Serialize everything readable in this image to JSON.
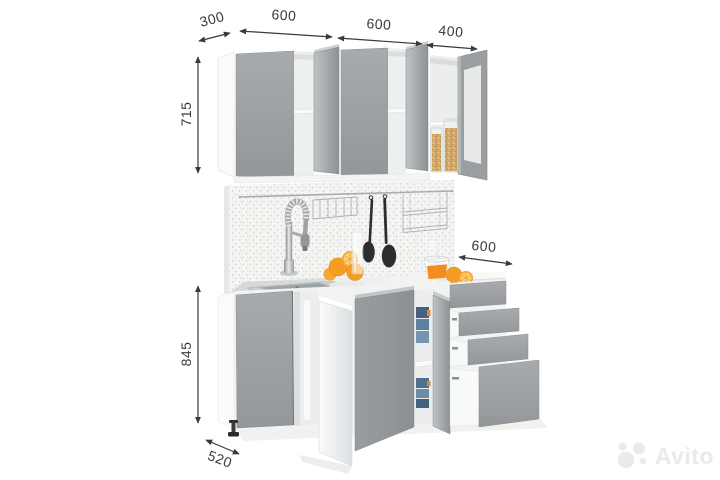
{
  "watermark": {
    "brand": "Avito"
  },
  "dimensions": {
    "top_widths": [
      {
        "value": "300"
      },
      {
        "value": "600"
      },
      {
        "value": "600"
      },
      {
        "value": "400"
      }
    ],
    "upper_cabinet_height": "715",
    "base_cabinet_height": "845",
    "base_depth": "520",
    "counter_section_width": "600"
  },
  "scene": {
    "items": [
      "wall-cabinets",
      "glass-door-cabinet",
      "cereal-jars",
      "backsplash",
      "utensil-rail",
      "hanging-utensils",
      "wire-racks",
      "spring-faucet",
      "sink",
      "countertop",
      "oranges",
      "juice-bowl",
      "base-cabinets",
      "food-containers",
      "drawer-unit",
      "adjustable-foot"
    ]
  },
  "colors": {
    "cabinet_front": "#9da0a3",
    "carcass_white": "#f4f5f5",
    "dimension_ink": "#3a3a3c",
    "orange": "#f49d22",
    "utensil": "#2d2d2f",
    "watermark": "#e9eae9"
  }
}
